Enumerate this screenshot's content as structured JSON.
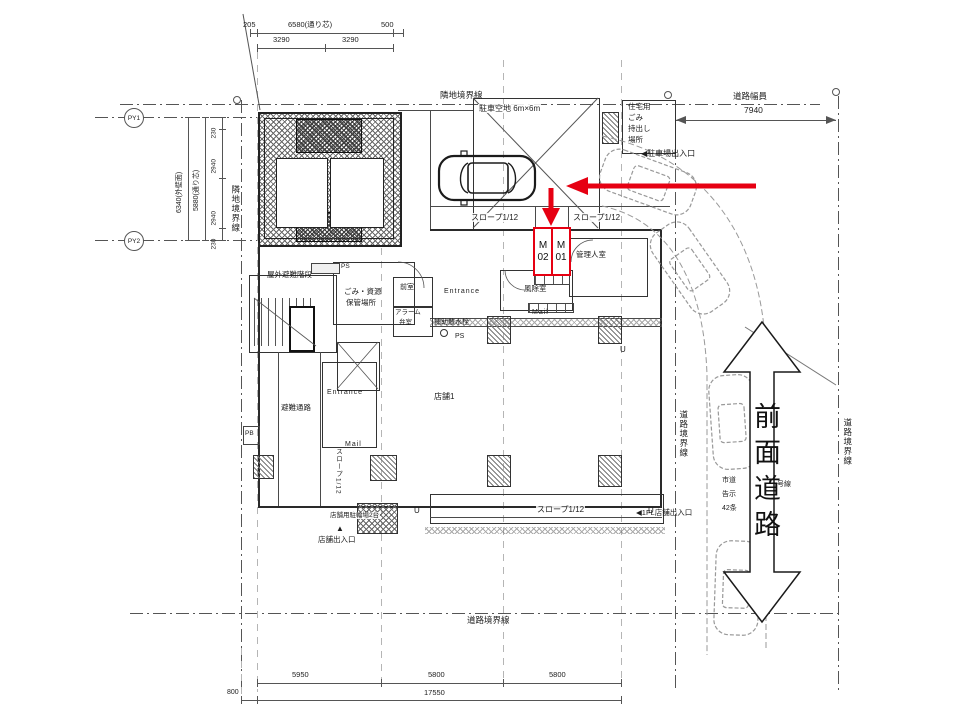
{
  "labels": {
    "adjacent_top": "隣地境界線",
    "adjacent_left": "隣地境界線",
    "road_boundary_mid": "道路境界線",
    "road_boundary_right": "道路境界線",
    "road_boundary_bottom": "道路境界線",
    "road_width": "道路幅員",
    "road_width_value": "7940",
    "parking_clear": "駐車空地 6m×6m",
    "trash_house_1": "住宅用",
    "trash_house_2": "ごみ",
    "trash_house_3": "持出し",
    "trash_house_4": "場所",
    "parking_exit": "◀駐車場出入口",
    "slope_left": "スロープ1/12",
    "slope_right": "スロープ1/12",
    "slope_bottom": "スロープ1/12",
    "slope_vertical": "スロープ1/12",
    "m02": "M02",
    "m01": "M01",
    "manager_room": "管理人室",
    "windbreak_room": "風除室",
    "mail_upper": "Mail",
    "entrance_upper": "Entrance",
    "aux_sprinkler": "補助散水栓",
    "ps_1": "PS",
    "ps_2": "PS",
    "trash_storage_1": "ごみ・資源",
    "trash_storage_2": "保管場所",
    "outdoor_stairs": "屋外避難階段",
    "anteroom": "前室",
    "alarm_valve_1": "アラーム",
    "alarm_valve_2": "弁室",
    "evac_passage": "避難通路",
    "entrance_lower": "Entrance",
    "mail_lower": "Mail",
    "store1": "店舗1",
    "pb": "PB",
    "bike_parking": "店舗用駐輪場2台",
    "store_exit_marker": "▲",
    "store_exit": "店舗出入口",
    "fl1_store_exit": "◀1FL店舗出入口",
    "front_road": "前面道路",
    "city_road_1": "市道",
    "city_road_2": "告示",
    "city_road_3": "42条",
    "city_road_4": "号線",
    "u1": "U",
    "u2": "U",
    "u3": "U",
    "py1": "PY1",
    "py2": "PY2"
  },
  "dimensions": {
    "top_205": "205",
    "top_6580": "6580(通り芯)",
    "top_500": "500",
    "top_3290a": "3290",
    "top_3290b": "3290",
    "left_230a": "230",
    "left_2940a": "2940",
    "left_2940b": "2940",
    "left_230b": "230",
    "left_6340": "6340(外壁面)",
    "left_5880": "5880(通り芯)",
    "bottom_5950": "5950",
    "bottom_5800a": "5800",
    "bottom_5800b": "5800",
    "bottom_17550": "17550",
    "bottom_800": "800"
  },
  "colors": {
    "annotation_red": "#e60012",
    "line_dark": "#333333"
  }
}
